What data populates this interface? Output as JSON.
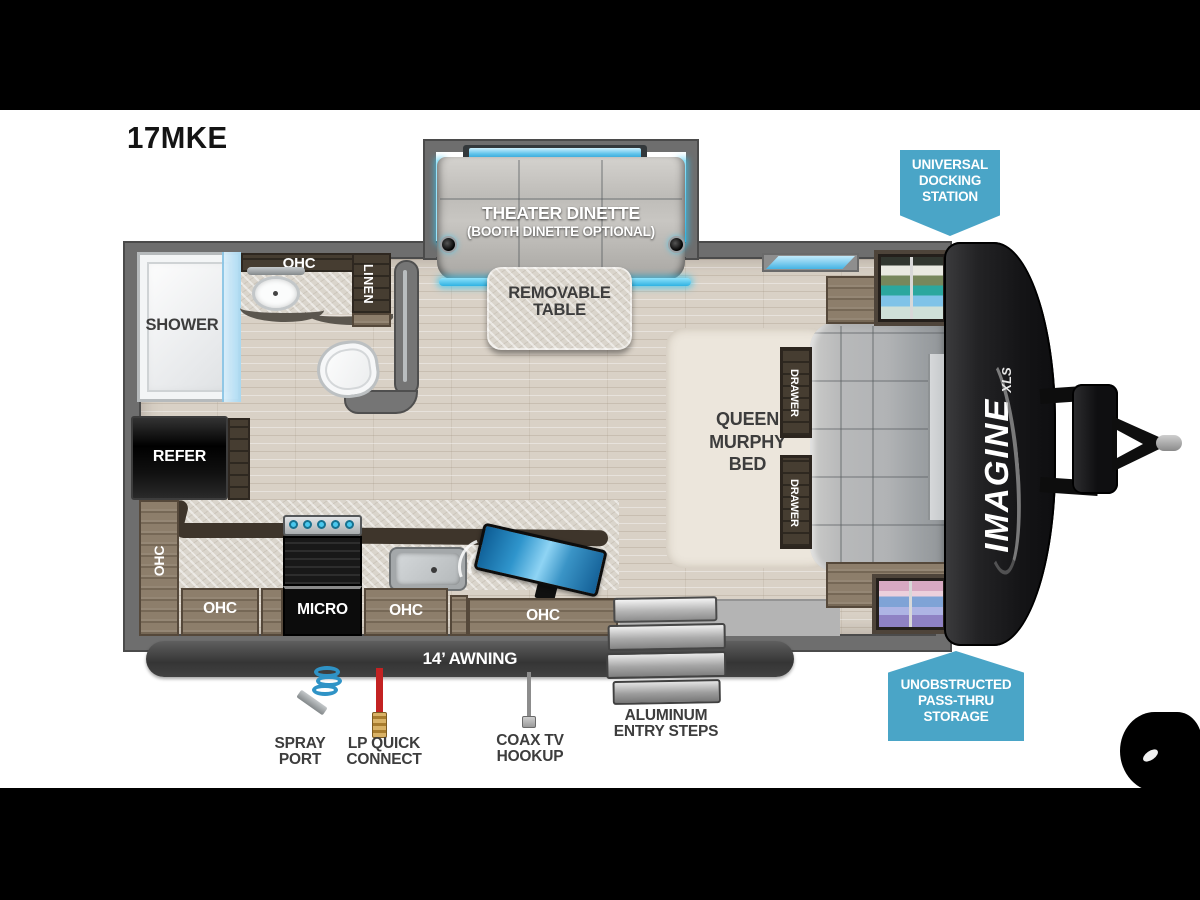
{
  "title": "17MKE",
  "brand": {
    "name": "IMAGINE",
    "series": "XLS"
  },
  "badges": {
    "docking1": "UNIVERSAL",
    "docking2": "DOCKING",
    "docking3": "STATION",
    "pass1": "UNOBSTRUCTED",
    "pass2": "PASS-THRU",
    "pass3": "STORAGE"
  },
  "rooms": {
    "theater": "THEATER DINETTE",
    "theater_sub": "(BOOTH DINETTE OPTIONAL)",
    "table1": "REMOVABLE",
    "table2": "TABLE",
    "bed1": "QUEEN",
    "bed2": "MURPHY",
    "bed3": "BED",
    "shower": "SHOWER",
    "linen": "LINEN",
    "refer": "REFER",
    "micro": "MICRO",
    "ohc": "OHC",
    "drawer": "DRAWER"
  },
  "callouts": {
    "awning": "14’ AWNING",
    "steps1": "ALUMINUM",
    "steps2": "ENTRY STEPS",
    "spray1": "SPRAY",
    "spray2": "PORT",
    "lp1": "LP QUICK",
    "lp2": "CONNECT",
    "coax1": "COAX TV",
    "coax2": "HOOKUP"
  },
  "colors": {
    "badge_blue": "#4aa5c7",
    "accent_cyan": "#38c6f0",
    "wall_gray": "#6e6e6e",
    "awning_gray": "#3f3f3f",
    "floor_wood": "#d9d1c6"
  }
}
